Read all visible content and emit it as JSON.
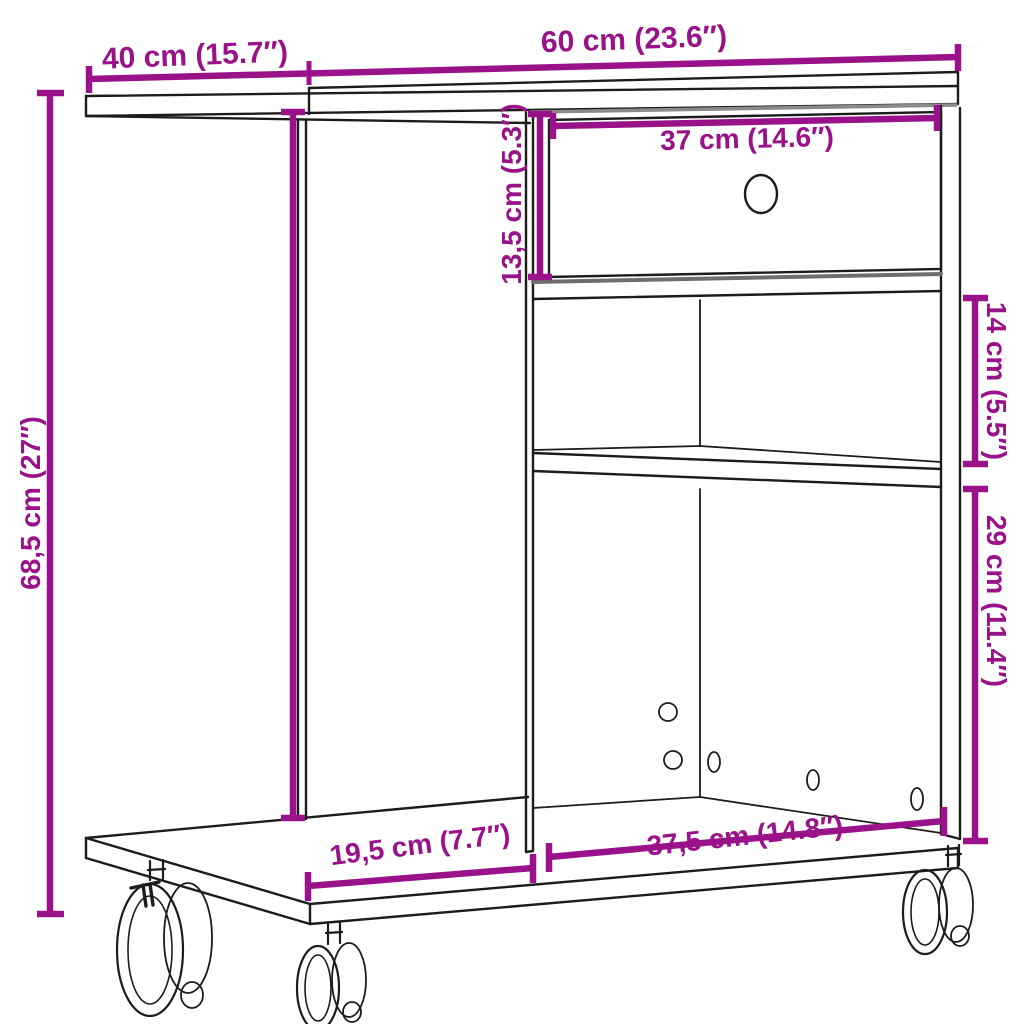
{
  "figure": {
    "subject": "Mobile side table / printer stand with drawer, two open compartments and four casters — dimension diagram",
    "background_color": "#ffffff",
    "accent_color": "#9A1289",
    "line_color": "#1c1c1c",
    "labels": {
      "top_depth": "40 cm (15.7″)",
      "top_width": "60 cm (23.6″)",
      "drawer_width": "37 cm (14.6″)",
      "drawer_height": "13,5 cm (5.3″)",
      "upper_compartment_height": "14 cm (5.5″)",
      "lower_compartment_height": "29 cm (11.4″)",
      "total_height": "68,5 cm (27″)",
      "base_width": "37,5 cm (14.8″)",
      "base_depth": "19,5 cm (7.7″)"
    }
  }
}
